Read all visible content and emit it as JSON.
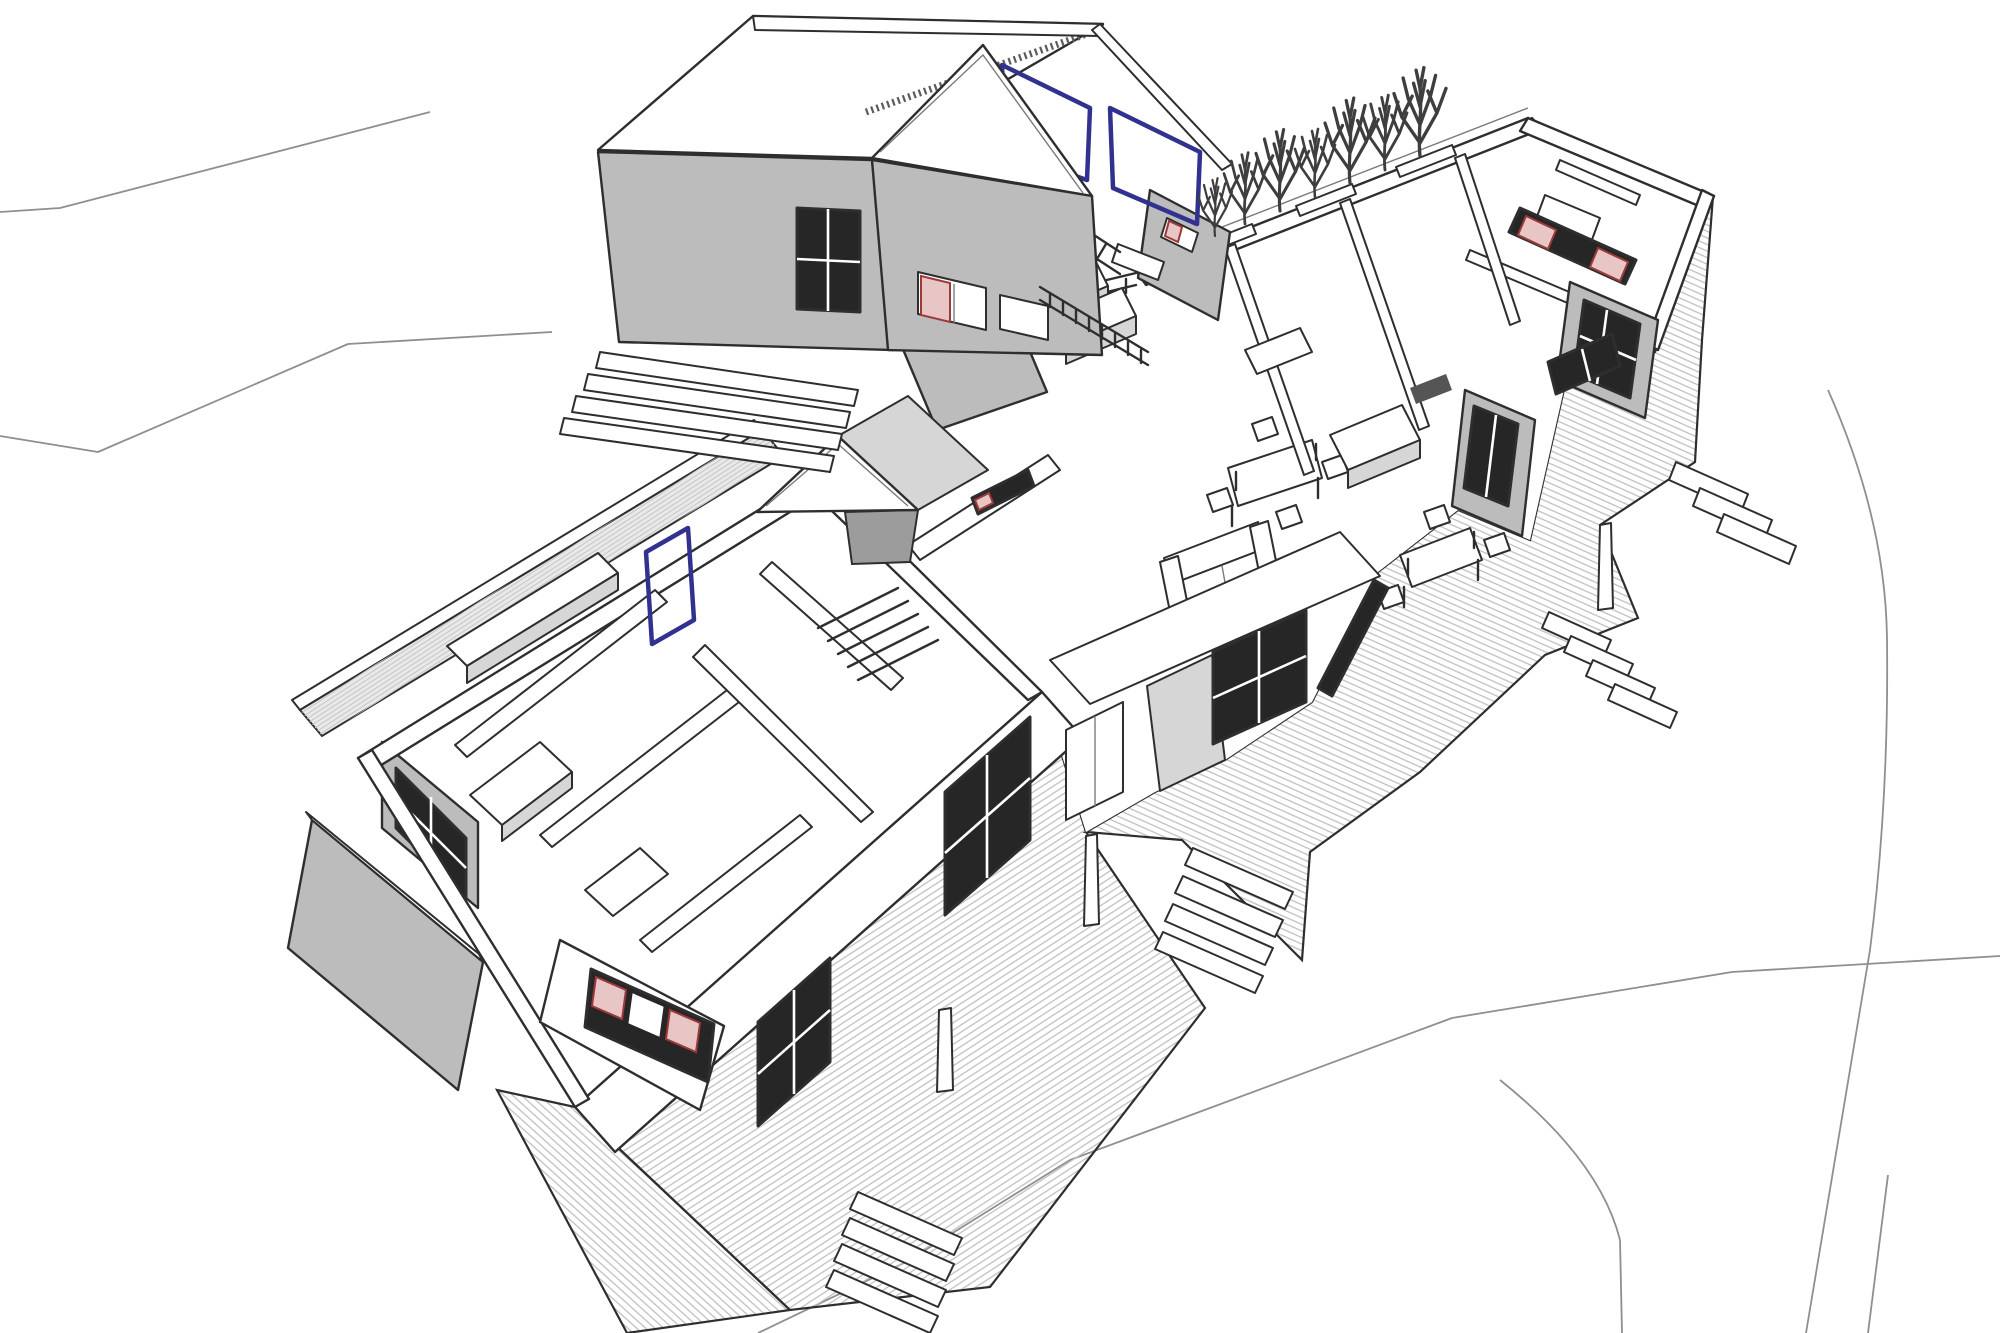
{
  "page": {
    "title": "3D axonometric cutaway floor plan drawing",
    "description": "Black-and-white 3D dollhouse cutaway architectural drawing of a single-storey house with a detached gabled garage, a connecting timber walkway lined with shrubs, wrap-around decks, four exterior stair flights, interior furniture, navy door frames and red accent windows, drawn on a white site plan with faint terrain contour lines."
  },
  "colors": {
    "background": "#ffffff",
    "ink": "#2e2e2e",
    "ink_soft": "#7a7a7a",
    "terrain_line": "#8f8f8f",
    "wall_gray": "#bcbcbc",
    "wall_gray_light": "#d6d6d6",
    "shadow_gray": "#9c9c9c",
    "deck_line": "#bdbdbd",
    "hatch_line": "#c6c6c6",
    "glass_dark": "#262626",
    "accent_navy": "#31318f",
    "accent_red": "#9c3a3a",
    "accent_pink": "#e9c6c6",
    "tree_ink": "#3e3e3e"
  },
  "scene": {
    "view": "axonometric dollhouse cutaway, roof removed over main house",
    "buildings": [
      {
        "name": "detached garage",
        "features": [
          "gray gable end walls",
          "white pitched roof",
          "two navy garage-door frames",
          "interior stair",
          "slatted balustrade",
          "full-width entry steps",
          "red accent window"
        ]
      },
      {
        "name": "main house right wing",
        "features": [
          "open-top bedroom walls",
          "red clerestory window band",
          "gray gable glazing",
          "dark rug",
          "beds and wardrobes"
        ]
      },
      {
        "name": "main house left wing",
        "features": [
          "bedroom and bathroom partition walls",
          "navy interior door",
          "hatched privacy screen wall",
          "red accent gable window band",
          "black framed windows",
          "interior stair"
        ]
      }
    ],
    "site_features": [
      "faint terrain contour lines",
      "row of seven bare shrubs along walkway",
      "hatched timber walkway",
      "wrap-around hatched decks",
      "four exterior stair flights",
      "deck bollards",
      "gray corner fence screen"
    ],
    "furniture": [
      "kitchen counters",
      "dining table with four chairs",
      "sofa",
      "outdoor table with chairs",
      "low cabinet",
      "bathroom vanity"
    ]
  }
}
